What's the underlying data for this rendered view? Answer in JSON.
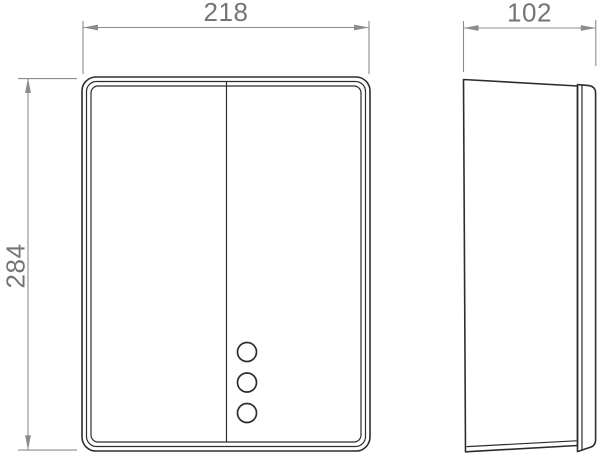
{
  "drawing": {
    "type": "technical-dimension-drawing",
    "dimensions": {
      "width": {
        "value": "218"
      },
      "height": {
        "value": "284"
      },
      "depth": {
        "value": "102"
      }
    },
    "colors": {
      "part_line": "#2d2d2d",
      "dimension_line": "#8c8c8c",
      "dimension_text": "#757575",
      "background": "#ffffff"
    }
  }
}
